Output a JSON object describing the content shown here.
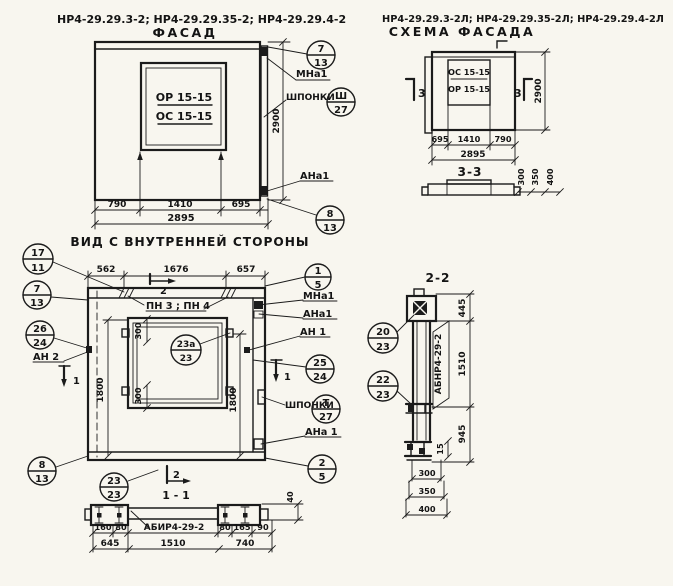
{
  "palette": {
    "ink": "#1b1b1b",
    "paper": "#f8f6ef"
  },
  "facade": {
    "codes": "НР4-29.29.3-2; НР4-29.29.35-2; НР4-29.29.4-2",
    "title": "ФАСАД",
    "subtitle": "ВИД С ВНУТРЕННЕЙ СТОРОНЫ",
    "window": {
      "line1": "ОР 15-15",
      "line2": "ОС 15-15"
    },
    "dims": {
      "w1": "790",
      "w2": "1410",
      "w3": "695",
      "total": "2895",
      "height": "2900"
    },
    "labels": {
      "mna1": "МНа1",
      "shponki": "ШПОНКИ",
      "ana1": "АНа1"
    },
    "callouts": {
      "c7_13": {
        "top": "7",
        "bottom": "13"
      },
      "sh_27": {
        "top": "Ш",
        "bottom": "27"
      },
      "c8_13": {
        "top": "8",
        "bottom": "13"
      }
    }
  },
  "schema": {
    "codes": "НР4-29.29.3-2Л; НР4-29.29.35-2Л; НР4-29.29.4-2Л",
    "title": "СХЕМА ФАСАДА",
    "window": {
      "line1": "ОС 15-15",
      "line2": "ОР 15-15"
    },
    "dims": {
      "w1": "695",
      "w2": "1410",
      "w3": "790",
      "total": "2895",
      "height": "2900",
      "p1": "300",
      "p2": "350",
      "p3": "400"
    },
    "marks": {
      "left": "3",
      "right": "3"
    },
    "section_title": "3-3"
  },
  "innerview": {
    "dims": {
      "w1": "562",
      "w2": "1676",
      "w3": "657",
      "h_left": "1800",
      "h_right": "1800",
      "win_top": "300",
      "win_bottom": "300"
    },
    "labels": {
      "pn": "ПН 3 ; ПН 4",
      "mna1": "МНа1",
      "ana1": "АНа1",
      "an1": "АН 1",
      "an2": "АН 2",
      "ana1b": "АНа 1",
      "shponki": "ШПОНКИ"
    },
    "marks": {
      "sec2": "2",
      "sec1_left": "1",
      "sec1_right": "1"
    },
    "callouts": {
      "c17_11": {
        "top": "17",
        "bottom": "11"
      },
      "c7_13": {
        "top": "7",
        "bottom": "13"
      },
      "c26_24": {
        "top": "26",
        "bottom": "24"
      },
      "c8_13": {
        "top": "8",
        "bottom": "13"
      },
      "c1_5": {
        "top": "1",
        "bottom": "5"
      },
      "c25_24": {
        "top": "25",
        "bottom": "24"
      },
      "t_27": {
        "top": "Т",
        "bottom": "27"
      },
      "c2_5": {
        "top": "2",
        "bottom": "5"
      },
      "c23a_23": {
        "top": "23а",
        "bottom": "23"
      }
    }
  },
  "section11": {
    "title": "1 - 1",
    "marker": "2",
    "beam_label": "АБИР4-29-2",
    "callout_23_23": {
      "top": "23",
      "bottom": "23"
    },
    "dims": {
      "d40": "40",
      "d160": "160",
      "d80a": "80",
      "d80b": "80",
      "d165": "165",
      "d90": "90",
      "d645": "645",
      "d1510": "1510",
      "d740": "740"
    }
  },
  "section22": {
    "title": "2-2",
    "beam_label": "АБНР4-29-2",
    "callouts": {
      "c20_23": {
        "top": "20",
        "bottom": "23"
      },
      "c22_23": {
        "top": "22",
        "bottom": "23"
      }
    },
    "dims": {
      "d445": "445",
      "d1510": "1510",
      "d945": "945",
      "d15": "15",
      "d300": "300",
      "d350": "350",
      "d400": "400"
    }
  }
}
